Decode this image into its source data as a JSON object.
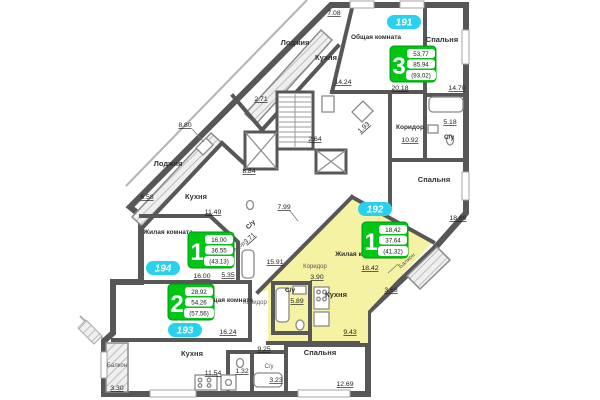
{
  "plan": {
    "type": "residential-floor-plan",
    "highlight_color": "#f5f2a4",
    "wall_color": "#575757",
    "badge_color": "#27d2ef",
    "info_box_color": "#00c714"
  },
  "apartments": [
    {
      "number": "191",
      "rooms_digit": "3",
      "areas": [
        "53,77",
        "85,94",
        "(93,02)"
      ],
      "rooms": [
        {
          "name": "Лоджия",
          "dim": "7.08"
        },
        {
          "name": "Кухня",
          "dim": "14.24"
        },
        {
          "name": "Общая комната",
          "dim": "20.18"
        },
        {
          "name": "Спальня",
          "dim": "14.70"
        },
        {
          "name": "С/у",
          "dim": "5.18"
        },
        {
          "name": "Коридор",
          "dim": "10.92"
        },
        {
          "name": "Спальня",
          "dim": "18.89"
        },
        {
          "name": "",
          "dim": "1.93"
        }
      ]
    },
    {
      "number": "192",
      "rooms_digit": "1",
      "areas": [
        "18,42",
        "37,64",
        "(41,32)"
      ],
      "rooms": [
        {
          "name": "Жилая комната",
          "dim": "18.42"
        },
        {
          "name": "Кухня",
          "dim": "9.43"
        },
        {
          "name": "С/у",
          "dim": "5.89"
        },
        {
          "name": "Коридор",
          "dim": "3.90"
        },
        {
          "name": "Балкон",
          "dim": "3.68"
        }
      ]
    },
    {
      "number": "193",
      "rooms_digit": "2",
      "areas": [
        "28,92",
        "54,26",
        "(57,56)"
      ],
      "rooms": [
        {
          "name": "Общая комната",
          "dim": "16.24"
        },
        {
          "name": "Кухня",
          "dim": "11.54"
        },
        {
          "name": "Спальня",
          "dim": "12.69"
        },
        {
          "name": "Коридор",
          "dim": "9.25"
        },
        {
          "name": "С/у",
          "dim": "3.23"
        },
        {
          "name": "",
          "dim": "1.32"
        },
        {
          "name": "Балкон",
          "dim": "3.30"
        }
      ]
    },
    {
      "number": "194",
      "rooms_digit": "1",
      "areas": [
        "16,00",
        "36,55",
        "(43,13)"
      ],
      "rooms": [
        {
          "name": "Жилая комната",
          "dim": "16.00"
        },
        {
          "name": "Кухня",
          "dim": "11.49"
        },
        {
          "name": "Лоджия",
          "dim": "6.58"
        },
        {
          "name": "С/у",
          "dim": "3.71"
        },
        {
          "name": "Коридор",
          "dim": "5.35"
        }
      ]
    }
  ],
  "core": {
    "dims": [
      "2.71",
      "2.64",
      "8.80",
      "8.84",
      "15.91",
      "7.99"
    ]
  }
}
